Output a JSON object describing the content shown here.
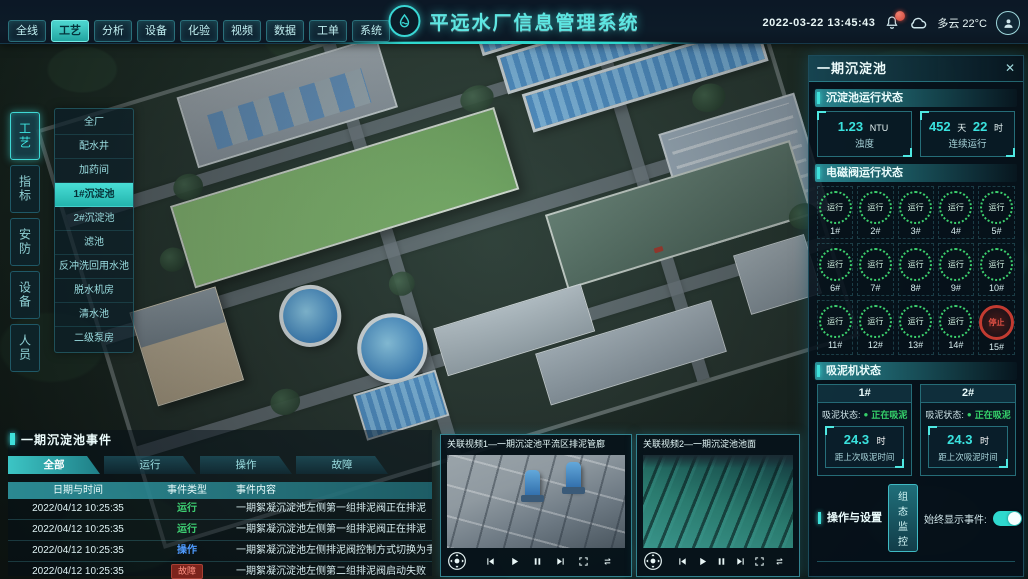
{
  "top_bar": {
    "title": "平远水厂信息管理系统",
    "datetime": "2022-03-22 13:45:43",
    "weather": "多云 22°C",
    "tabs": [
      {
        "label": "全线",
        "active": false
      },
      {
        "label": "工艺",
        "active": true
      },
      {
        "label": "分析",
        "active": false
      },
      {
        "label": "设备",
        "active": false
      },
      {
        "label": "化验",
        "active": false
      },
      {
        "label": "视频",
        "active": false
      },
      {
        "label": "数据",
        "active": false
      },
      {
        "label": "工单",
        "active": false
      },
      {
        "label": "系统",
        "active": false
      }
    ]
  },
  "left_nav": {
    "tabs": [
      {
        "label": "工艺",
        "active": true
      },
      {
        "label": "指标",
        "active": false
      },
      {
        "label": "安防",
        "active": false
      },
      {
        "label": "设备",
        "active": false
      },
      {
        "label": "人员",
        "active": false
      }
    ],
    "menu": [
      {
        "label": "全厂",
        "active": false
      },
      {
        "label": "配水井",
        "active": false
      },
      {
        "label": "加药间",
        "active": false
      },
      {
        "label": "1#沉淀池",
        "active": true
      },
      {
        "label": "2#沉淀池",
        "active": false
      },
      {
        "label": "滤池",
        "active": false
      },
      {
        "label": "反冲洗回用水池",
        "active": false
      },
      {
        "label": "脱水机房",
        "active": false
      },
      {
        "label": "清水池",
        "active": false
      },
      {
        "label": "二级泵房",
        "active": false
      }
    ]
  },
  "right_panel": {
    "title": "一期沉淀池",
    "close_glyph": "✕",
    "run_status": {
      "title": "沉淀池运行状态",
      "turbidity": {
        "value": "1.23",
        "unit": "NTU",
        "label": "浊度"
      },
      "uptime": {
        "days": "452",
        "days_unit": "天",
        "hours": "22",
        "hours_unit": "时",
        "label": "连续运行"
      }
    },
    "valves": {
      "title": "电磁阀运行状态",
      "items": [
        {
          "id": "1#",
          "status": "运行",
          "state": "run"
        },
        {
          "id": "2#",
          "status": "运行",
          "state": "run"
        },
        {
          "id": "3#",
          "status": "运行",
          "state": "run"
        },
        {
          "id": "4#",
          "status": "运行",
          "state": "run"
        },
        {
          "id": "5#",
          "status": "运行",
          "state": "run"
        },
        {
          "id": "6#",
          "status": "运行",
          "state": "run"
        },
        {
          "id": "7#",
          "status": "运行",
          "state": "run"
        },
        {
          "id": "8#",
          "status": "运行",
          "state": "run"
        },
        {
          "id": "9#",
          "status": "运行",
          "state": "run"
        },
        {
          "id": "10#",
          "status": "运行",
          "state": "run"
        },
        {
          "id": "11#",
          "status": "运行",
          "state": "run"
        },
        {
          "id": "12#",
          "status": "运行",
          "state": "run"
        },
        {
          "id": "13#",
          "status": "运行",
          "state": "run"
        },
        {
          "id": "14#",
          "status": "运行",
          "state": "run"
        },
        {
          "id": "15#",
          "status": "停止",
          "state": "stop"
        }
      ]
    },
    "suction": {
      "title": "吸泥机状态",
      "machines": [
        {
          "id": "1#",
          "status_label": "吸泥状态:",
          "status_dot": "●",
          "status": "正在吸泥",
          "value": "24.3",
          "unit": "时",
          "caption": "距上次吸泥时间"
        },
        {
          "id": "2#",
          "status_label": "吸泥状态:",
          "status_dot": "●",
          "status": "正在吸泥",
          "value": "24.3",
          "unit": "时",
          "caption": "距上次吸泥时间"
        }
      ]
    },
    "ops": {
      "title": "操作与设置",
      "button": "组态监控",
      "toggle_label": "始终显示事件:",
      "toggle_on": true
    }
  },
  "events_panel": {
    "title": "一期沉淀池事件",
    "tabs": [
      {
        "label": "全部",
        "active": true
      },
      {
        "label": "运行",
        "active": false
      },
      {
        "label": "操作",
        "active": false
      },
      {
        "label": "故障",
        "active": false
      }
    ],
    "columns": [
      "日期与时间",
      "事件类型",
      "事件内容"
    ],
    "rows": [
      {
        "time": "2022/04/12 10:25:35",
        "type": "运行",
        "type_key": "run",
        "content": "一期絮凝沉淀池左侧第一组排泥阀正在排泥"
      },
      {
        "time": "2022/04/12 10:25:35",
        "type": "运行",
        "type_key": "run",
        "content": "一期絮凝沉淀池左侧第一组排泥阀正在排泥"
      },
      {
        "time": "2022/04/12 10:25:35",
        "type": "操作",
        "type_key": "op",
        "content": "一期絮凝沉淀池左侧排泥阀控制方式切换为手动"
      },
      {
        "time": "2022/04/12 10:25:35",
        "type": "故障",
        "type_key": "fault",
        "content": "一期絮凝沉淀池左侧第二组排泥阀启动失败"
      }
    ]
  },
  "videos": [
    {
      "title": "关联视频1—一期沉淀池平流区排泥管廊"
    },
    {
      "title": "关联视频2—一期沉淀池池面"
    }
  ],
  "icons": {
    "logo": "water-drop-logo",
    "top_right": [
      "bell-icon",
      "cloud-icon",
      "avatar-icon"
    ],
    "video_controls": [
      "pan-dpad",
      "skip-back",
      "play",
      "pause",
      "skip-forward",
      "fullscreen",
      "loop"
    ]
  },
  "colors": {
    "accent": "#39d7d4",
    "run_green": "#3ed173",
    "op_blue": "#4f9bff",
    "fault_red": "#a84034",
    "stop_red": "#c23b31"
  }
}
